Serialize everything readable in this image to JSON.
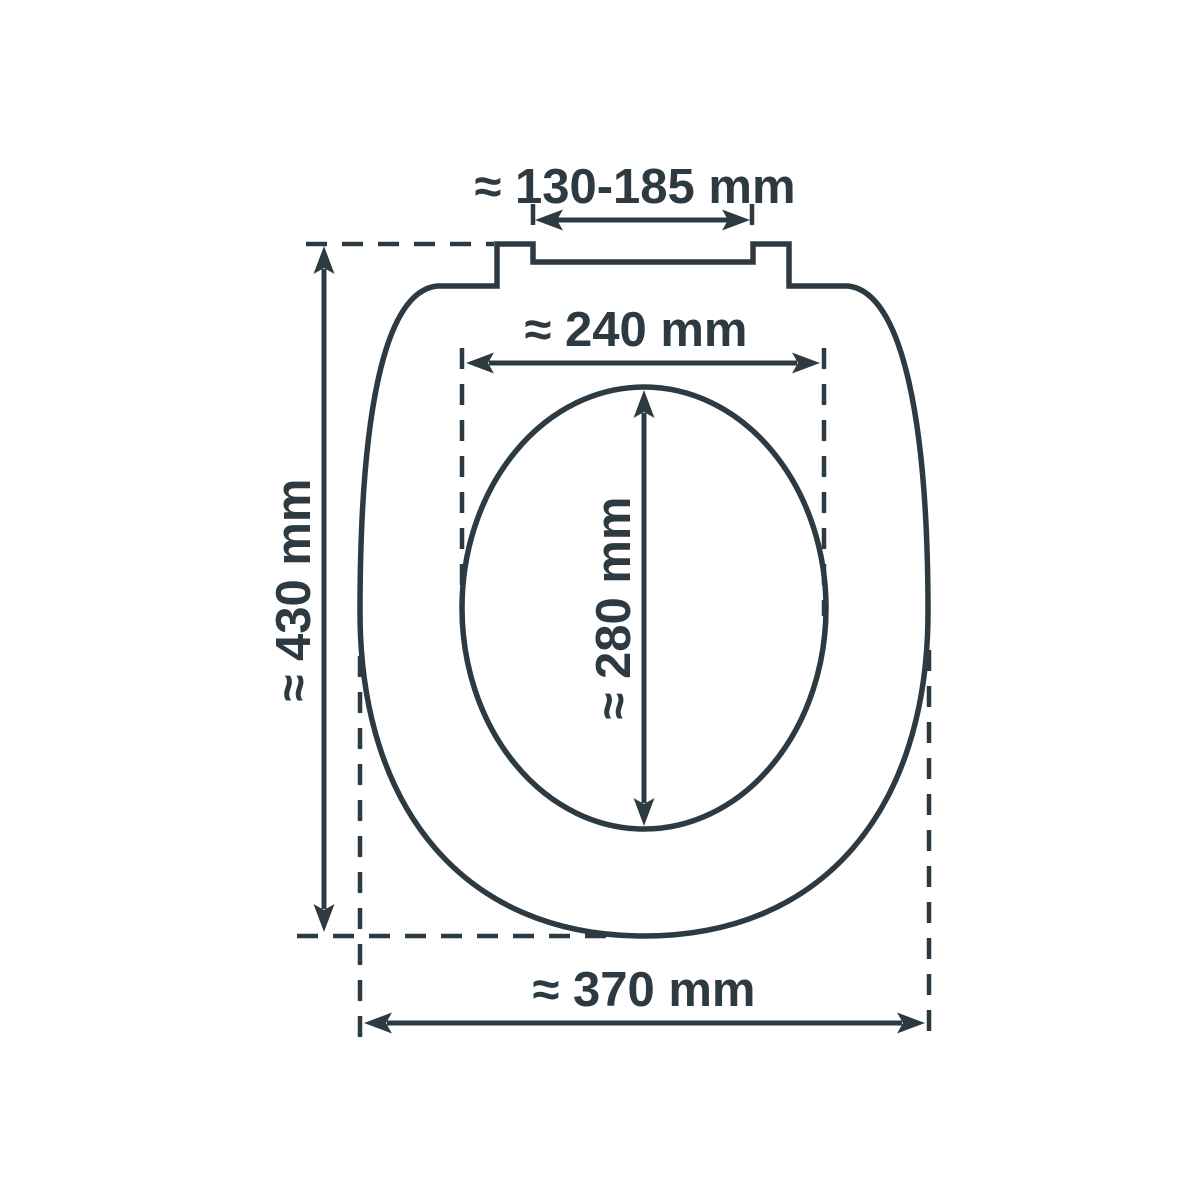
{
  "diagram": {
    "subject": "toilet-seat-top-view-dimension-drawing",
    "colors": {
      "ink": "#2d3a42",
      "background": "#ffffff"
    },
    "dimensions": {
      "hinge_hole_spacing": {
        "label": "≈ 130-185 mm",
        "value_min_mm": 130,
        "value_max_mm": 185
      },
      "inner_width": {
        "label": "≈ 240 mm",
        "value_mm": 240
      },
      "inner_length": {
        "label": "≈ 280 mm",
        "value_mm": 280
      },
      "seat_length": {
        "label": "≈ 430 mm",
        "value_mm": 430
      },
      "seat_width": {
        "label": "≈ 370 mm",
        "value_mm": 370
      }
    }
  }
}
